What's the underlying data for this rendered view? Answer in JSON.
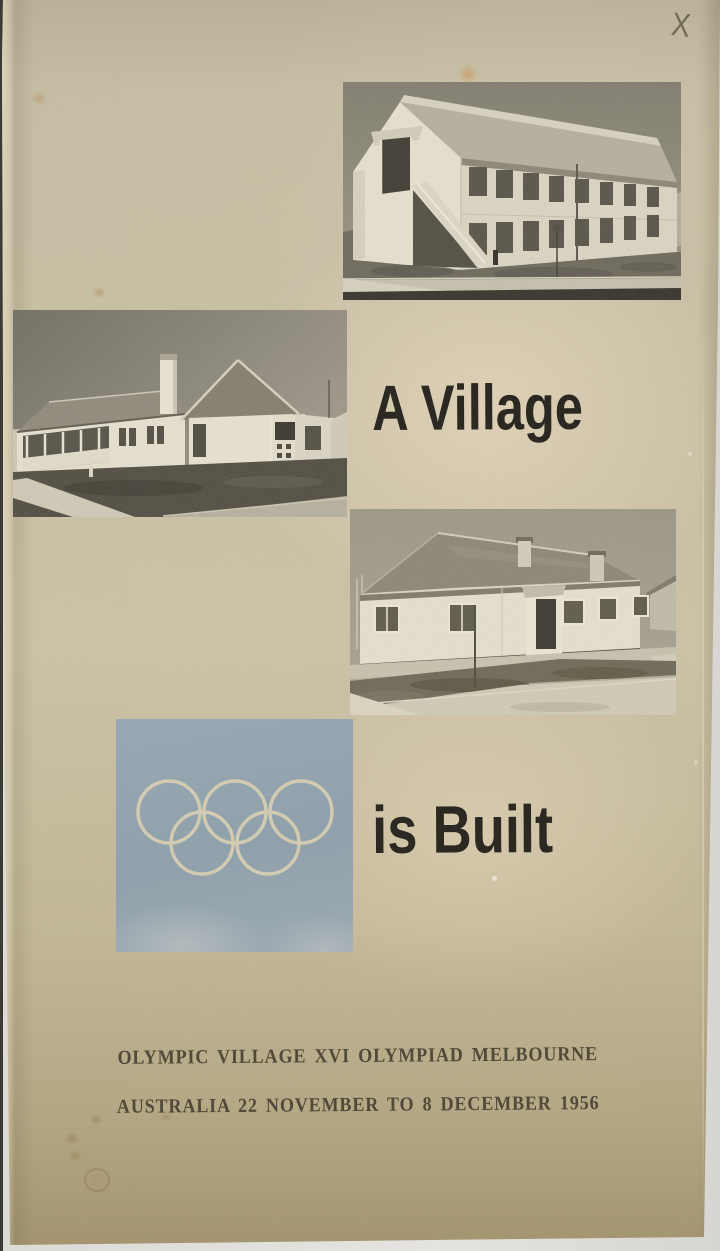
{
  "cover": {
    "title_line1": "A Village",
    "title_line2": "is Built",
    "footer_line1": "OLYMPIC VILLAGE XVI OLYMPIAD MELBOURNE",
    "footer_line2": "AUSTRALIA 22 NOVEMBER TO 8 DECEMBER 1956",
    "pencil_mark": "X"
  },
  "emblem": {
    "label": "olympic-rings",
    "ring_count": 5
  },
  "photos": [
    {
      "id": "photo-top",
      "label": "two-storey accommodation block with external staircase"
    },
    {
      "id": "photo-mid",
      "label": "single-storey house with tall chimney and verandah"
    },
    {
      "id": "photo-bot",
      "label": "single-storey duplex house with central porch"
    }
  ],
  "colors": {
    "paper": "#c9c1a6",
    "paper_shadow": "#a3946e",
    "paper_highlight": "#eddfc5",
    "backdrop": "#e2e1dd",
    "square_blue": "#93a4b0",
    "rings_cream": "#d8d0b4",
    "title_ink": "#26241d",
    "footer_ink": "#4e4636",
    "pencil": "#635d4c"
  }
}
